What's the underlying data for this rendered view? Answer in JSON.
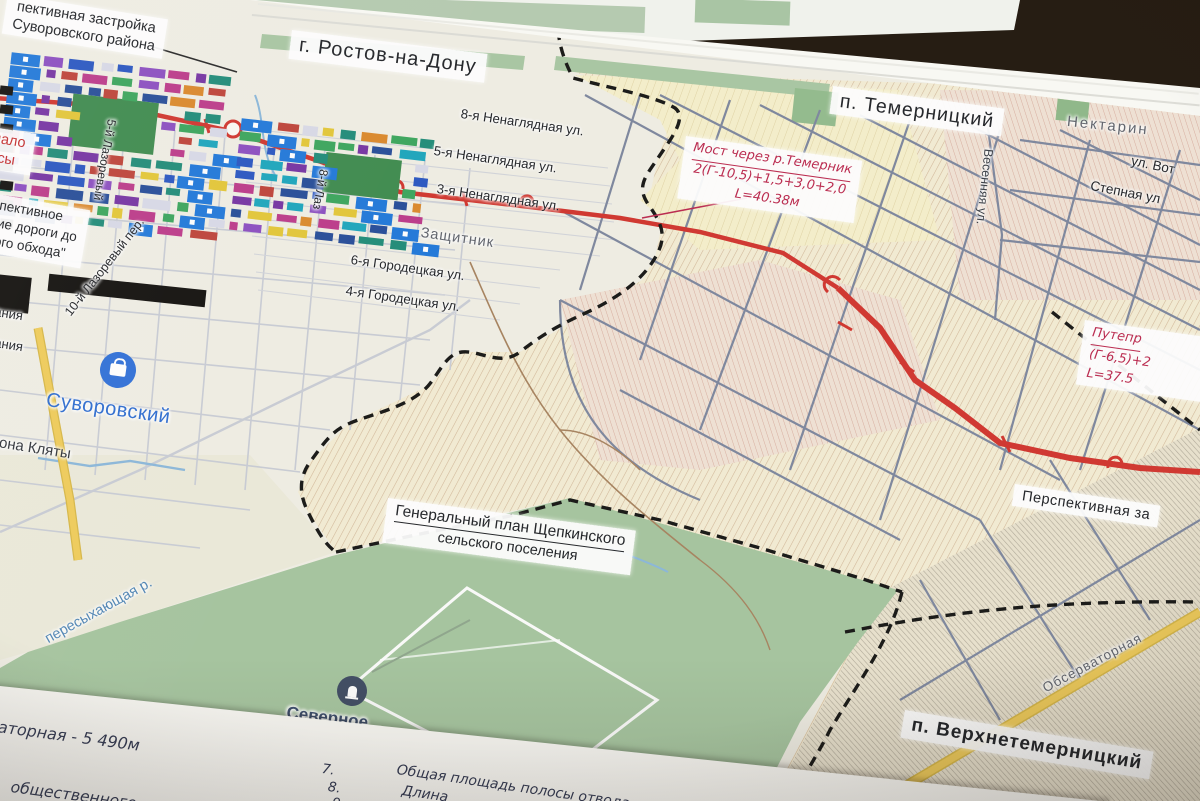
{
  "surface": {
    "table_color": "#261d13"
  },
  "map": {
    "labels": {
      "development_note": {
        "line1": "пективная застройка",
        "line2": "Суворовского района"
      },
      "city": "г. Ростов-на-Дону",
      "settlement_temernitsky": "п. Темерницкий",
      "settlement_verkhnetemernitsky": "п. Верхнетемерницкий",
      "genplan": {
        "line1": "Генеральный план Щепкинского",
        "line2": "сельского поселения"
      },
      "perspective_development": "Перспективная за",
      "road_note": {
        "line1": "спективное",
        "line2": "ние дороги до",
        "line3": "ного обхода\""
      },
      "route_start": {
        "line1": "нало",
        "line2": "ссы"
      }
    },
    "annotations": {
      "bridge": {
        "line1": "Мост через р.Темерник",
        "line2": "2(Г-10,5)+1,5+3,0+2,0",
        "line3": "L=40.38м"
      },
      "overpass": {
        "line1": "Путепр",
        "line2": "(Г-6,5)+2",
        "line3": "L=37.5"
      }
    },
    "streets": {
      "nenaglyadnaya_8": "8-я Ненаглядная ул.",
      "nenaglyadnaya_5": "5-я Ненаглядная ул.",
      "nenaglyadnaya_3": "3-я Ненаглядная ул.",
      "gorodetskaya_6": "6-я Городецкая ул.",
      "gorodetskaya_4": "4-я Городецкая ул.",
      "vesennyaya": "Весенняя ул.",
      "stepnaya": "Степная ул",
      "vot": "ул. Вот",
      "lazorevy_10": "10-й Лазоревый пер.",
      "lazorevy_5": "5-й Лазоревый",
      "lazorevy_8": "8-й Лаз",
      "platona_klyaty": "атона Кляты",
      "tanya_a": "тания",
      "tanya_b": "тания",
      "observatornaya": "Обсерваторная"
    },
    "places": {
      "suvorovsky": "Суворовский",
      "severnoye": "Северное",
      "nektarin": "Нектарин",
      "zashchitnik": "Защитник"
    },
    "water": {
      "river": "пересыхающая р."
    },
    "colors": {
      "highlight_road_red": "#d8362e",
      "annotation_red": "#c22a50",
      "place_blue": "#2e6fd6",
      "cemetery_navy": "#414e66",
      "parcel_beige": "#f4ecd2",
      "greenery": "#a6c69e",
      "street_gray_blue": "#7e88a0",
      "yellow_road": "#f2cd55"
    }
  },
  "notes_sheet": {
    "measure_line": "ваторная - 5 490м",
    "bottom_line": "общественного наз",
    "items": [
      {
        "num": "7.",
        "text": "Общая площадь полосы отвода"
      },
      {
        "num": "8.",
        "text": "Длина"
      },
      {
        "num": "9.",
        "text": ""
      }
    ]
  }
}
